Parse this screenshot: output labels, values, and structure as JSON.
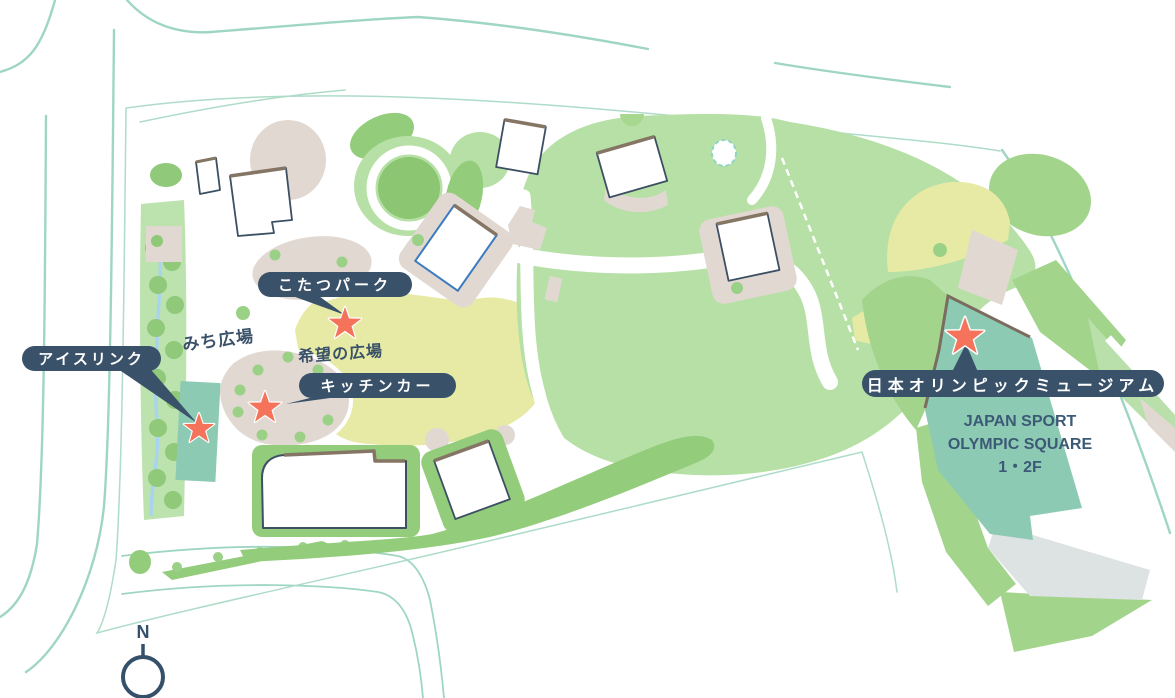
{
  "pins": [
    {
      "label": "こたつパーク"
    },
    {
      "label": "アイスリンク"
    },
    {
      "label": "キッチンカー"
    },
    {
      "label": "日本オリンピックミュージアム"
    }
  ],
  "areas": [
    {
      "name": "みち広場"
    },
    {
      "name": "希望の広場"
    }
  ],
  "museum_caption": {
    "line1": "JAPAN SPORT",
    "line2": "OLYMPIC SQUARE",
    "line3": "1・2F"
  },
  "compass": {
    "label": "N"
  },
  "colors": {
    "accent_navy": "#3a5269",
    "star": "#f4735a",
    "lawn_green": "#b7e0a6",
    "mid_green": "#93cc7b",
    "grounds_green": "#a3d48c",
    "yellow_green": "#e6eaa4",
    "beige": "#e2d8d2",
    "teal_building": "#8ccab4",
    "gray_plaza": "#dde2e2",
    "road": "#9fd6c3",
    "stream_blue": "#a9d4ef"
  }
}
